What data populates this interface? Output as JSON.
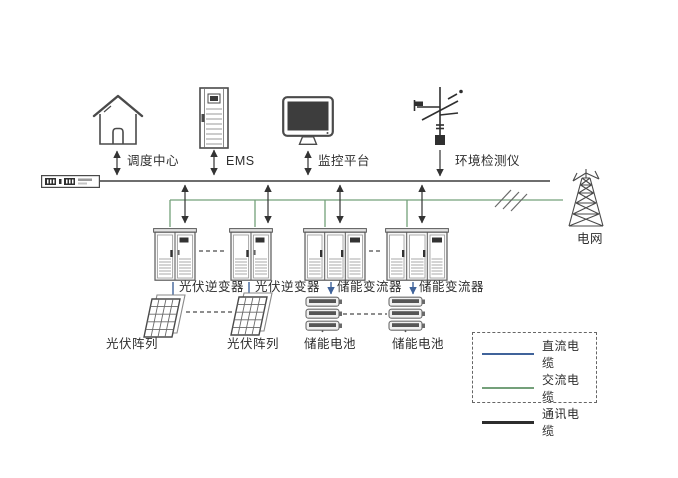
{
  "diagram": {
    "title": "光伏储能系统架构图",
    "top_nodes": [
      {
        "id": "dispatch-center",
        "icon": "house-icon",
        "label": "调度中心"
      },
      {
        "id": "ems",
        "icon": "server-rack-icon",
        "label": "EMS"
      },
      {
        "id": "monitoring-platform",
        "icon": "monitor-icon",
        "label": "监控平台"
      },
      {
        "id": "environment-detector",
        "icon": "weather-station-icon",
        "label": "环境检测仪"
      }
    ],
    "grid_node": {
      "id": "power-grid",
      "icon": "transmission-tower-icon",
      "label": "电网"
    },
    "converters": [
      {
        "id": "pv-inverter-1",
        "icon": "cabinet-2door-icon",
        "label": "光伏逆变器"
      },
      {
        "id": "pv-inverter-2",
        "icon": "cabinet-2door-icon",
        "label": "光伏逆变器"
      },
      {
        "id": "storage-converter-1",
        "icon": "cabinet-3door-icon",
        "label": "储能变流器"
      },
      {
        "id": "storage-converter-2",
        "icon": "cabinet-3door-icon",
        "label": "储能变流器"
      }
    ],
    "sources": [
      {
        "id": "pv-array-1",
        "icon": "solar-panel-icon",
        "label": "光伏阵列"
      },
      {
        "id": "pv-array-2",
        "icon": "solar-panel-icon",
        "label": "光伏阵列"
      },
      {
        "id": "storage-battery-1",
        "icon": "battery-stack-icon",
        "label": "储能电池"
      },
      {
        "id": "storage-battery-2",
        "icon": "battery-stack-icon",
        "label": "储能电池"
      }
    ],
    "legend": [
      {
        "label": "直流电缆",
        "color": "#40639a"
      },
      {
        "label": "交流电缆",
        "color": "#74a07a"
      },
      {
        "label": "通讯电缆",
        "color": "#2d2d2d"
      }
    ],
    "colors": {
      "dc": "#40639a",
      "ac": "#74a07a",
      "comm": "#3e3e3e"
    }
  }
}
